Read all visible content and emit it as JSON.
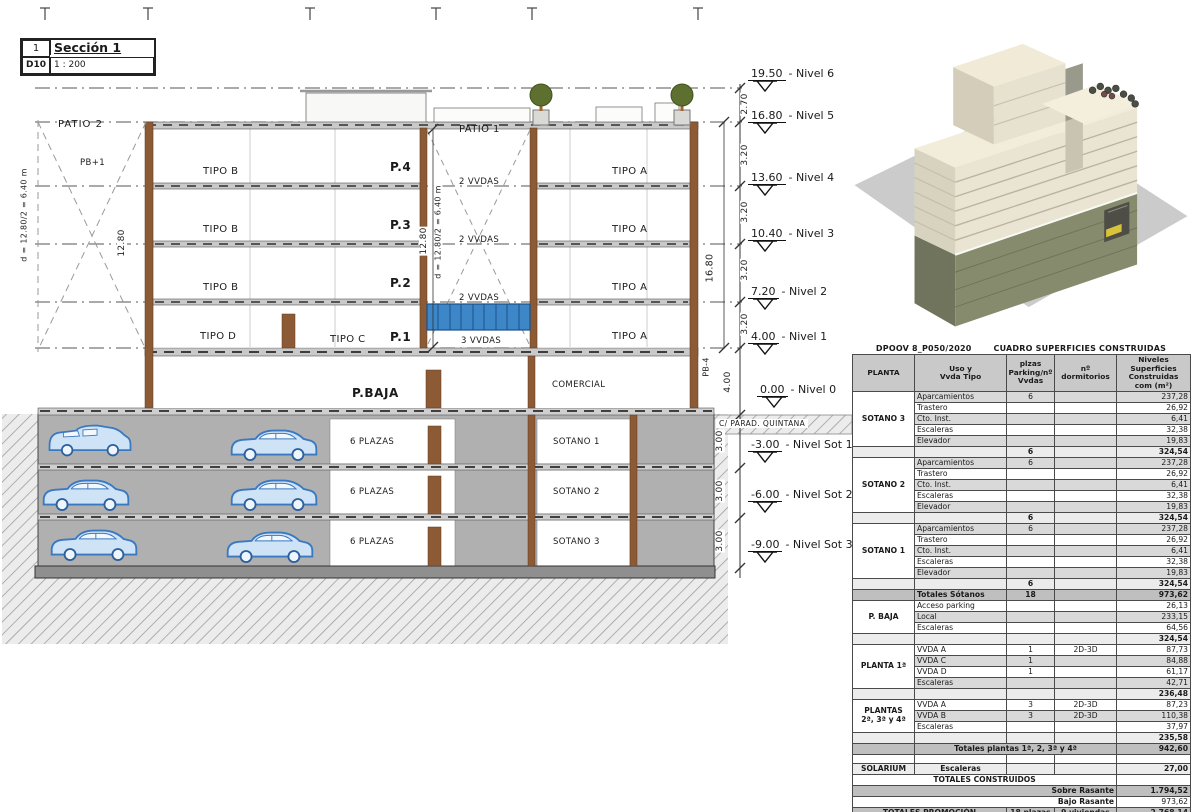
{
  "title_block": {
    "num": "1",
    "name": "Sección 1",
    "code": "D10",
    "scale": "1 : 200"
  },
  "section": {
    "labels": {
      "patio2": "PATIO 2",
      "pb1": "PB+1",
      "tipo_b": "TIPO B",
      "tipo_d": "TIPO D",
      "tipo_c": "TIPO C",
      "tipo_a": "TIPO A",
      "p4": "P.4",
      "p3": "P.3",
      "p2": "P.2",
      "p1": "P.1",
      "vvdas2": "2 VVDAS",
      "vvdas3": "3 VVDAS",
      "patio1": "PATIO 1",
      "pbaja": "P.BAJA",
      "comercial": "COMERCIAL",
      "plazas": "6 PLAZAS",
      "sot1": "SOTANO 1",
      "sot2": "SOTANO 2",
      "sot3": "SOTANO 3",
      "street": "C/ PARAD. QUINTANA"
    },
    "dims": {
      "d_left": "d = 12.80/2 = 6.40 m",
      "d_mid": "d = 12.80/2 = 6.40 m",
      "twelve": "12.80",
      "v270": "2.70",
      "v320": "3.20",
      "v1680": "16.80",
      "pb4": "PB-4",
      "v400": "4.00",
      "v300": "3.00"
    },
    "levels": [
      {
        "v": "19.50",
        "n": "- Nivel 6"
      },
      {
        "v": "16.80",
        "n": "- Nivel 5"
      },
      {
        "v": "13.60",
        "n": "- Nivel 4"
      },
      {
        "v": "10.40",
        "n": "- Nivel 3"
      },
      {
        "v": "7.20",
        "n": "- Nivel 2"
      },
      {
        "v": "4.00",
        "n": "- Nivel 1"
      },
      {
        "v": "0.00",
        "n": "- Nivel 0"
      },
      {
        "v": "-3.00",
        "n": "- Nivel Sot 1"
      },
      {
        "v": "-6.00",
        "n": "- Nivel Sot 2"
      },
      {
        "v": "-9.00",
        "n": "- Nivel Sot 3"
      }
    ]
  },
  "colors": {
    "wall_brown": "#8d5a36",
    "glazing_blue": "#3d86c8",
    "car_blue": "#cfe3f6",
    "earth_hatch_line": "#9a9a9a",
    "basement_olive": "#878b6e",
    "render_cream": "#eae5d3"
  },
  "table": {
    "title_left": "DPOOV 8_P050/2020",
    "title_right": "CUADRO SUPERFICIES CONSTRUIDAS",
    "headers": [
      "PLANTA",
      "Uso y\nVvda Tipo",
      "plzas\nParking/nº\nVvdas",
      "nº\ndormitorios",
      "Niveles\nSuperficies\nConstruidas\ncom (m²)"
    ],
    "rows": [
      {
        "cls": "a",
        "cells": [
          {
            "t": "SOTANO 3",
            "rs": 5,
            "cls": "planta"
          },
          {
            "t": "Aparcamientos",
            "cls": "uso"
          },
          {
            "t": "6"
          },
          {
            "t": ""
          },
          {
            "t": "237,28",
            "cls": "num"
          }
        ]
      },
      {
        "cls": "",
        "cells": [
          {
            "t": "Trastero",
            "cls": "uso"
          },
          {
            "t": ""
          },
          {
            "t": ""
          },
          {
            "t": "26,92",
            "cls": "num"
          }
        ]
      },
      {
        "cls": "a",
        "cells": [
          {
            "t": "Cto. Inst.",
            "cls": "uso"
          },
          {
            "t": ""
          },
          {
            "t": ""
          },
          {
            "t": "6,41",
            "cls": "num"
          }
        ]
      },
      {
        "cls": "",
        "cells": [
          {
            "t": "Escaleras",
            "cls": "uso"
          },
          {
            "t": ""
          },
          {
            "t": ""
          },
          {
            "t": "32,38",
            "cls": "num"
          }
        ]
      },
      {
        "cls": "a",
        "cells": [
          {
            "t": "Elevador",
            "cls": "uso"
          },
          {
            "t": ""
          },
          {
            "t": ""
          },
          {
            "t": "19,83",
            "cls": "num"
          }
        ]
      },
      {
        "cls": "sub",
        "cells": [
          {
            "t": "",
            "cls": "planta"
          },
          {
            "t": "",
            "cls": "uso"
          },
          {
            "t": "6"
          },
          {
            "t": ""
          },
          {
            "t": "324,54",
            "cls": "num"
          }
        ]
      },
      {
        "cls": "a",
        "cells": [
          {
            "t": "SOTANO 2",
            "rs": 5,
            "cls": "planta"
          },
          {
            "t": "Aparcamientos",
            "cls": "uso"
          },
          {
            "t": "6"
          },
          {
            "t": ""
          },
          {
            "t": "237,28",
            "cls": "num"
          }
        ]
      },
      {
        "cls": "",
        "cells": [
          {
            "t": "Trastero",
            "cls": "uso"
          },
          {
            "t": ""
          },
          {
            "t": ""
          },
          {
            "t": "26,92",
            "cls": "num"
          }
        ]
      },
      {
        "cls": "a",
        "cells": [
          {
            "t": "Cto. Inst.",
            "cls": "uso"
          },
          {
            "t": ""
          },
          {
            "t": ""
          },
          {
            "t": "6,41",
            "cls": "num"
          }
        ]
      },
      {
        "cls": "",
        "cells": [
          {
            "t": "Escaleras",
            "cls": "uso"
          },
          {
            "t": ""
          },
          {
            "t": ""
          },
          {
            "t": "32,38",
            "cls": "num"
          }
        ]
      },
      {
        "cls": "a",
        "cells": [
          {
            "t": "Elevador",
            "cls": "uso"
          },
          {
            "t": ""
          },
          {
            "t": ""
          },
          {
            "t": "19,83",
            "cls": "num"
          }
        ]
      },
      {
        "cls": "sub",
        "cells": [
          {
            "t": "",
            "cls": "planta"
          },
          {
            "t": "",
            "cls": "uso"
          },
          {
            "t": "6"
          },
          {
            "t": ""
          },
          {
            "t": "324,54",
            "cls": "num"
          }
        ]
      },
      {
        "cls": "a",
        "cells": [
          {
            "t": "SOTANO 1",
            "rs": 5,
            "cls": "planta"
          },
          {
            "t": "Aparcamientos",
            "cls": "uso"
          },
          {
            "t": "6"
          },
          {
            "t": ""
          },
          {
            "t": "237,28",
            "cls": "num"
          }
        ]
      },
      {
        "cls": "",
        "cells": [
          {
            "t": "Trastero",
            "cls": "uso"
          },
          {
            "t": ""
          },
          {
            "t": ""
          },
          {
            "t": "26,92",
            "cls": "num"
          }
        ]
      },
      {
        "cls": "a",
        "cells": [
          {
            "t": "Cto. Inst.",
            "cls": "uso"
          },
          {
            "t": ""
          },
          {
            "t": ""
          },
          {
            "t": "6,41",
            "cls": "num"
          }
        ]
      },
      {
        "cls": "",
        "cells": [
          {
            "t": "Escaleras",
            "cls": "uso"
          },
          {
            "t": ""
          },
          {
            "t": ""
          },
          {
            "t": "32,38",
            "cls": "num"
          }
        ]
      },
      {
        "cls": "a",
        "cells": [
          {
            "t": "Elevador",
            "cls": "uso"
          },
          {
            "t": ""
          },
          {
            "t": ""
          },
          {
            "t": "19,83",
            "cls": "num"
          }
        ]
      },
      {
        "cls": "sub",
        "cells": [
          {
            "t": "",
            "cls": "planta"
          },
          {
            "t": "",
            "cls": "uso"
          },
          {
            "t": "6"
          },
          {
            "t": ""
          },
          {
            "t": "324,54",
            "cls": "num"
          }
        ]
      },
      {
        "cls": "tot",
        "cells": [
          {
            "t": "",
            "cls": "planta"
          },
          {
            "t": "Totales Sótanos",
            "cls": "uso"
          },
          {
            "t": "18"
          },
          {
            "t": ""
          },
          {
            "t": "973,62",
            "cls": "num"
          }
        ]
      },
      {
        "cls": "",
        "cells": [
          {
            "t": "P. BAJA",
            "rs": 3,
            "cls": "planta"
          },
          {
            "t": "Acceso parking",
            "cls": "uso"
          },
          {
            "t": ""
          },
          {
            "t": ""
          },
          {
            "t": "26,13",
            "cls": "num"
          }
        ]
      },
      {
        "cls": "a",
        "cells": [
          {
            "t": "Local",
            "cls": "uso"
          },
          {
            "t": ""
          },
          {
            "t": ""
          },
          {
            "t": "233,15",
            "cls": "num"
          }
        ]
      },
      {
        "cls": "",
        "cells": [
          {
            "t": "Escaleras",
            "cls": "uso"
          },
          {
            "t": ""
          },
          {
            "t": ""
          },
          {
            "t": "64,56",
            "cls": "num"
          }
        ]
      },
      {
        "cls": "sub",
        "cells": [
          {
            "t": "",
            "cls": "planta"
          },
          {
            "t": "",
            "cls": "uso"
          },
          {
            "t": ""
          },
          {
            "t": ""
          },
          {
            "t": "324,54",
            "cls": "num"
          }
        ]
      },
      {
        "cls": "",
        "cells": [
          {
            "t": "PLANTA 1ª",
            "rs": 4,
            "cls": "planta"
          },
          {
            "t": "VVDA A",
            "cls": "uso"
          },
          {
            "t": "1"
          },
          {
            "t": "2D-3D"
          },
          {
            "t": "87,73",
            "cls": "num"
          }
        ]
      },
      {
        "cls": "a",
        "cells": [
          {
            "t": "VVDA C",
            "cls": "uso"
          },
          {
            "t": "1"
          },
          {
            "t": ""
          },
          {
            "t": "84,88",
            "cls": "num"
          }
        ]
      },
      {
        "cls": "",
        "cells": [
          {
            "t": "VVDA D",
            "cls": "uso"
          },
          {
            "t": "1"
          },
          {
            "t": ""
          },
          {
            "t": "61,17",
            "cls": "num"
          }
        ]
      },
      {
        "cls": "a",
        "cells": [
          {
            "t": "Escaleras",
            "cls": "uso"
          },
          {
            "t": ""
          },
          {
            "t": ""
          },
          {
            "t": "42,71",
            "cls": "num"
          }
        ]
      },
      {
        "cls": "sub",
        "cells": [
          {
            "t": "",
            "cls": "planta"
          },
          {
            "t": "",
            "cls": "uso"
          },
          {
            "t": ""
          },
          {
            "t": ""
          },
          {
            "t": "236,48",
            "cls": "num"
          }
        ]
      },
      {
        "cls": "",
        "cells": [
          {
            "t": "PLANTAS\n2ª, 3ª y 4ª",
            "rs": 3,
            "cls": "planta"
          },
          {
            "t": "VVDA A",
            "cls": "uso"
          },
          {
            "t": "3"
          },
          {
            "t": "2D-3D"
          },
          {
            "t": "87,23",
            "cls": "num"
          }
        ]
      },
      {
        "cls": "a",
        "cells": [
          {
            "t": "VVDA B",
            "cls": "uso"
          },
          {
            "t": "3"
          },
          {
            "t": "2D-3D"
          },
          {
            "t": "110,38",
            "cls": "num"
          }
        ]
      },
      {
        "cls": "",
        "cells": [
          {
            "t": "Escaleras",
            "cls": "uso"
          },
          {
            "t": ""
          },
          {
            "t": ""
          },
          {
            "t": "37,97",
            "cls": "num"
          }
        ]
      },
      {
        "cls": "sub",
        "cells": [
          {
            "t": "",
            "cls": "planta"
          },
          {
            "t": "",
            "cls": "uso"
          },
          {
            "t": ""
          },
          {
            "t": ""
          },
          {
            "t": "235,58",
            "cls": "num"
          }
        ]
      },
      {
        "cls": "tot",
        "cells": [
          {
            "t": "",
            "cls": "planta"
          },
          {
            "t": "Totales plantas 1ª, 2, 3ª y 4ª",
            "cs": 3,
            "cls": "uso-c"
          },
          {
            "t": "942,60",
            "cls": "num"
          }
        ]
      },
      {
        "cls": "spacer",
        "cells": [
          {
            "t": ""
          },
          {
            "t": ""
          },
          {
            "t": ""
          },
          {
            "t": ""
          },
          {
            "t": ""
          }
        ]
      },
      {
        "cls": "sub",
        "cells": [
          {
            "t": "SOLARIUM",
            "cls": "planta"
          },
          {
            "t": "Escaleras",
            "cls": "uso-c"
          },
          {
            "t": ""
          },
          {
            "t": ""
          },
          {
            "t": "27,00",
            "cls": "num"
          }
        ]
      },
      {
        "cls": "tc",
        "cells": [
          {
            "t": "TOTALES CONSTRUIDOS",
            "cs": 4,
            "cls": "uso-c"
          },
          {
            "t": ""
          }
        ]
      },
      {
        "cls": "tot",
        "cells": [
          {
            "t": "Sobre Rasante",
            "cs": 4,
            "cls": "right"
          },
          {
            "t": "1.794,52",
            "cls": "num"
          }
        ]
      },
      {
        "cls": "",
        "cells": [
          {
            "t": "Bajo Rasante",
            "cs": 4,
            "cls": "right"
          },
          {
            "t": "973,62",
            "cls": "num"
          }
        ]
      },
      {
        "cls": "tot",
        "cells": [
          {
            "t": "TOTALES PROMOCIÓN",
            "cs": 2,
            "cls": "planta"
          },
          {
            "t": "18 plazas"
          },
          {
            "t": "9 viviendas"
          },
          {
            "t": "2.768,14",
            "cls": "num"
          }
        ]
      }
    ]
  }
}
